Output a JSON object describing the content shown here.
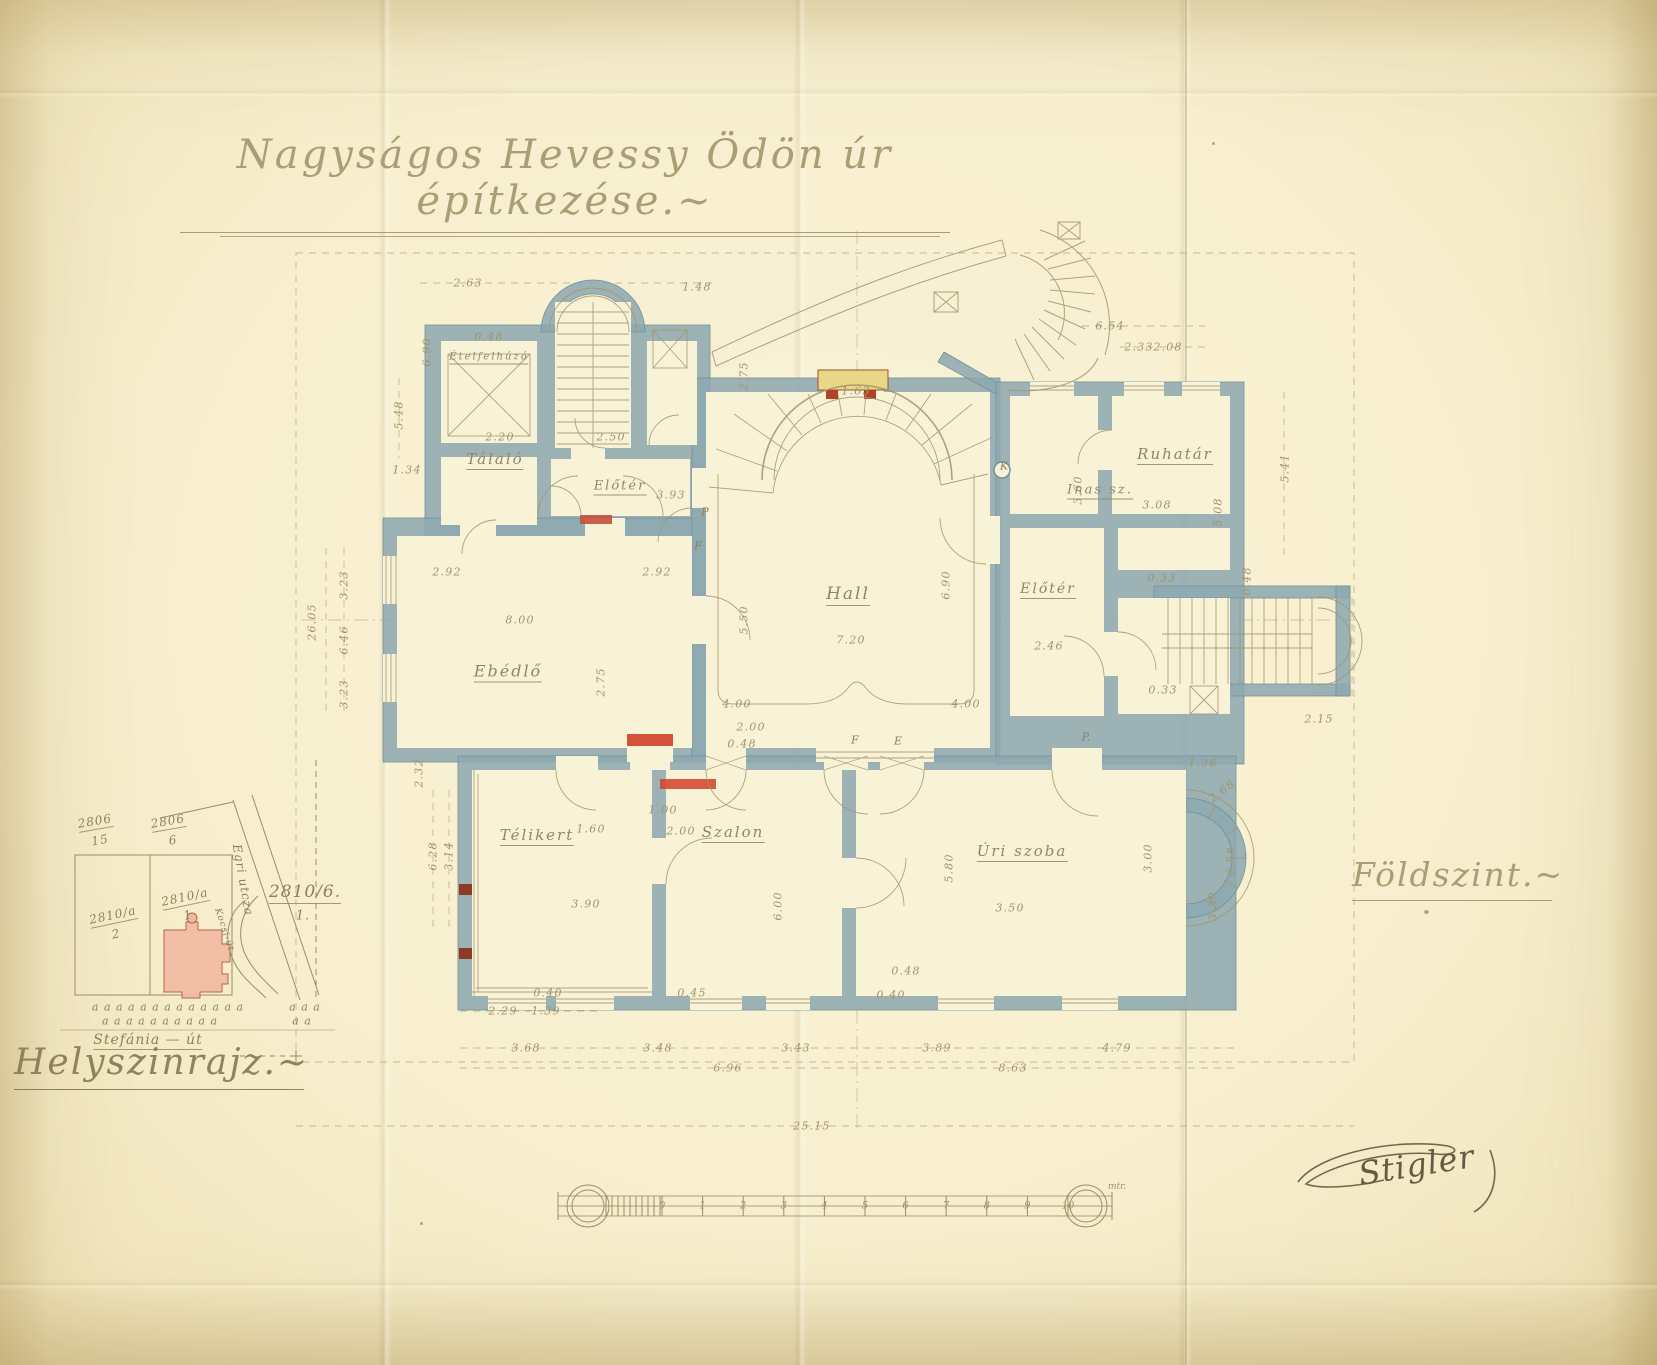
{
  "document": {
    "title": "Nagyságos Hevessy Ödön úr építkezése.~",
    "floor_label": "Földszint.~",
    "signature": "Stigler"
  },
  "floor_plan": {
    "rooms": [
      {
        "t": "Ételfelhúzó",
        "x": 489,
        "y": 358,
        "s": 10,
        "u": true
      },
      {
        "t": "Tálaló",
        "x": 495,
        "y": 460,
        "u": true
      },
      {
        "t": "Előtér",
        "x": 620,
        "y": 487,
        "s": 13,
        "u": true
      },
      {
        "t": "Ebédlő",
        "x": 508,
        "y": 672,
        "s": 16,
        "u": true
      },
      {
        "t": "Hall",
        "x": 848,
        "y": 595,
        "s": 17,
        "u": true
      },
      {
        "t": "Inas sz.",
        "x": 1100,
        "y": 491,
        "s": 13,
        "u": true
      },
      {
        "t": "Ruhatár",
        "x": 1175,
        "y": 455,
        "u": true
      },
      {
        "t": "Előtér",
        "x": 1048,
        "y": 590,
        "s": 14,
        "u": true
      },
      {
        "t": "Télikert",
        "x": 537,
        "y": 836,
        "u": true
      },
      {
        "t": "Szalon",
        "x": 733,
        "y": 833,
        "u": true
      },
      {
        "t": "Úri szoba",
        "x": 1022,
        "y": 852,
        "u": true
      }
    ],
    "markers": [
      {
        "t": "K",
        "x": 1004,
        "y": 466
      },
      {
        "t": "P",
        "x": 705,
        "y": 512
      },
      {
        "t": "P.",
        "x": 1086,
        "y": 737
      },
      {
        "t": "F",
        "x": 855,
        "y": 740
      },
      {
        "t": "E",
        "x": 898,
        "y": 741
      },
      {
        "t": "F",
        "x": 698,
        "y": 546
      }
    ],
    "dimensions": [
      {
        "t": "2.63",
        "x": 468,
        "y": 283
      },
      {
        "t": "1.48",
        "x": 697,
        "y": 287
      },
      {
        "t": "0.48",
        "x": 489,
        "y": 337
      },
      {
        "t": "6.90",
        "x": 427,
        "y": 352,
        "r": -90
      },
      {
        "t": "5.48",
        "x": 399,
        "y": 415,
        "r": -90
      },
      {
        "t": "1.34",
        "x": 407,
        "y": 470
      },
      {
        "t": "2.20",
        "x": 500,
        "y": 437
      },
      {
        "t": "2.50",
        "x": 611,
        "y": 437
      },
      {
        "t": "3.93",
        "x": 671,
        "y": 495
      },
      {
        "t": "2.75",
        "x": 744,
        "y": 376,
        "r": -90
      },
      {
        "t": "1.63",
        "x": 856,
        "y": 391
      },
      {
        "t": "6.54",
        "x": 1110,
        "y": 326
      },
      {
        "t": "2.33",
        "x": 1139,
        "y": 347
      },
      {
        "t": "2.08",
        "x": 1168,
        "y": 347
      },
      {
        "t": "5.41",
        "x": 1285,
        "y": 468,
        "r": -90
      },
      {
        "t": "3.60",
        "x": 1078,
        "y": 490,
        "r": -90
      },
      {
        "t": "3.08",
        "x": 1157,
        "y": 505
      },
      {
        "t": "5.08",
        "x": 1218,
        "y": 512,
        "r": -90
      },
      {
        "t": "26.05",
        "x": 312,
        "y": 622,
        "r": -90
      },
      {
        "t": "3.23",
        "x": 344,
        "y": 585,
        "r": -90
      },
      {
        "t": "6.46",
        "x": 344,
        "y": 640,
        "r": -90
      },
      {
        "t": "3.23",
        "x": 344,
        "y": 694,
        "r": -90
      },
      {
        "t": "2.92",
        "x": 447,
        "y": 572
      },
      {
        "t": "2.92",
        "x": 657,
        "y": 572
      },
      {
        "t": "8.00",
        "x": 520,
        "y": 620
      },
      {
        "t": "5.50",
        "x": 744,
        "y": 620,
        "r": -90
      },
      {
        "t": "2.75",
        "x": 601,
        "y": 682,
        "r": -90
      },
      {
        "t": "7.20",
        "x": 851,
        "y": 640
      },
      {
        "t": "6.90",
        "x": 946,
        "y": 585,
        "r": -90
      },
      {
        "t": "4.00",
        "x": 737,
        "y": 704
      },
      {
        "t": "2.00",
        "x": 751,
        "y": 727
      },
      {
        "t": "0.48",
        "x": 742,
        "y": 744
      },
      {
        "t": "4.00",
        "x": 966,
        "y": 704
      },
      {
        "t": "2.46",
        "x": 1049,
        "y": 646
      },
      {
        "t": "0.33",
        "x": 1162,
        "y": 578
      },
      {
        "t": "0.48",
        "x": 1247,
        "y": 581,
        "r": -90
      },
      {
        "t": "0.33",
        "x": 1163,
        "y": 690
      },
      {
        "t": "2.15",
        "x": 1319,
        "y": 719
      },
      {
        "t": "2.32",
        "x": 419,
        "y": 773,
        "r": -90
      },
      {
        "t": "6.28",
        "x": 433,
        "y": 856,
        "r": -90
      },
      {
        "t": "3.14",
        "x": 449,
        "y": 856,
        "r": -90
      },
      {
        "t": "1.00",
        "x": 663,
        "y": 810
      },
      {
        "t": "1.60",
        "x": 591,
        "y": 829
      },
      {
        "t": "2.00",
        "x": 681,
        "y": 831
      },
      {
        "t": "3.90",
        "x": 586,
        "y": 904
      },
      {
        "t": "6.00",
        "x": 778,
        "y": 906,
        "r": -90
      },
      {
        "t": "5.80",
        "x": 949,
        "y": 868,
        "r": -90
      },
      {
        "t": "3.50",
        "x": 1010,
        "y": 908
      },
      {
        "t": "1.36",
        "x": 1203,
        "y": 763
      },
      {
        "t": "2.68",
        "x": 1222,
        "y": 791,
        "r": -38
      },
      {
        "t": "3.00",
        "x": 1148,
        "y": 858,
        "r": -90
      },
      {
        "t": "6.58",
        "x": 1231,
        "y": 861,
        "r": -90
      },
      {
        "t": "3.39",
        "x": 1213,
        "y": 906,
        "r": -90
      },
      {
        "t": "0.40",
        "x": 548,
        "y": 993
      },
      {
        "t": "0.45",
        "x": 692,
        "y": 993
      },
      {
        "t": "0.40",
        "x": 891,
        "y": 995
      },
      {
        "t": "0.48",
        "x": 906,
        "y": 971
      },
      {
        "t": "2.29",
        "x": 503,
        "y": 1011
      },
      {
        "t": "1.39",
        "x": 546,
        "y": 1011
      },
      {
        "t": "3.68",
        "x": 526,
        "y": 1048
      },
      {
        "t": "3.48",
        "x": 658,
        "y": 1048
      },
      {
        "t": "3.43",
        "x": 796,
        "y": 1048
      },
      {
        "t": "3.89",
        "x": 937,
        "y": 1048
      },
      {
        "t": "4.79",
        "x": 1117,
        "y": 1048
      },
      {
        "t": "6.96",
        "x": 728,
        "y": 1068
      },
      {
        "t": "8.63",
        "x": 1013,
        "y": 1068
      },
      {
        "t": "25.15",
        "x": 812,
        "y": 1126
      }
    ]
  },
  "site_plan": {
    "label": "Helyszinrajz.~",
    "labels": [
      {
        "t": "2806",
        "x": 95,
        "y": 822,
        "r": -10,
        "u": true
      },
      {
        "t": "15",
        "x": 100,
        "y": 840,
        "r": -10
      },
      {
        "t": "2806",
        "x": 168,
        "y": 822,
        "r": -10,
        "u": true
      },
      {
        "t": "6",
        "x": 173,
        "y": 840,
        "r": -10
      },
      {
        "t": "2810/a",
        "x": 113,
        "y": 916,
        "r": -12,
        "u": true
      },
      {
        "t": "2",
        "x": 116,
        "y": 934,
        "r": -12
      },
      {
        "t": "2810/a",
        "x": 185,
        "y": 898,
        "r": -12,
        "u": true
      },
      {
        "t": "1",
        "x": 188,
        "y": 915,
        "r": -12
      },
      {
        "t": "2810/6.",
        "x": 305,
        "y": 893,
        "s": 17,
        "u": true
      },
      {
        "t": "1.",
        "x": 303,
        "y": 916,
        "s": 13
      },
      {
        "t": "Egri utcza",
        "x": 243,
        "y": 880,
        "r": 80,
        "s": 12
      },
      {
        "t": "Kocsi-út",
        "x": 224,
        "y": 930,
        "r": 72,
        "s": 9
      },
      {
        "t": "a a a   a a a a a a a a a a",
        "x": 168,
        "y": 1007,
        "s": 11
      },
      {
        "t": "a a a   a a a a a a a",
        "x": 160,
        "y": 1021,
        "s": 11
      },
      {
        "t": "a a  a",
        "x": 305,
        "y": 1007,
        "s": 11
      },
      {
        "t": "a  a",
        "x": 302,
        "y": 1021,
        "s": 11
      },
      {
        "t": "Stefánia — út",
        "x": 148,
        "y": 1041,
        "s": 14,
        "u": true
      }
    ]
  },
  "scale_bar": {
    "ticks": [
      "0",
      "1",
      "2",
      "3",
      "4",
      "5",
      "6",
      "7",
      "8",
      "9",
      "10"
    ],
    "unit": "mtr."
  },
  "colors": {
    "paper": "#f7efcf",
    "wall": "#8ea8b1",
    "ink": "#a3956c",
    "red_accent": "#c4503a",
    "yellow_accent": "#ead687",
    "footprint_pink": "#f2b9a2"
  }
}
